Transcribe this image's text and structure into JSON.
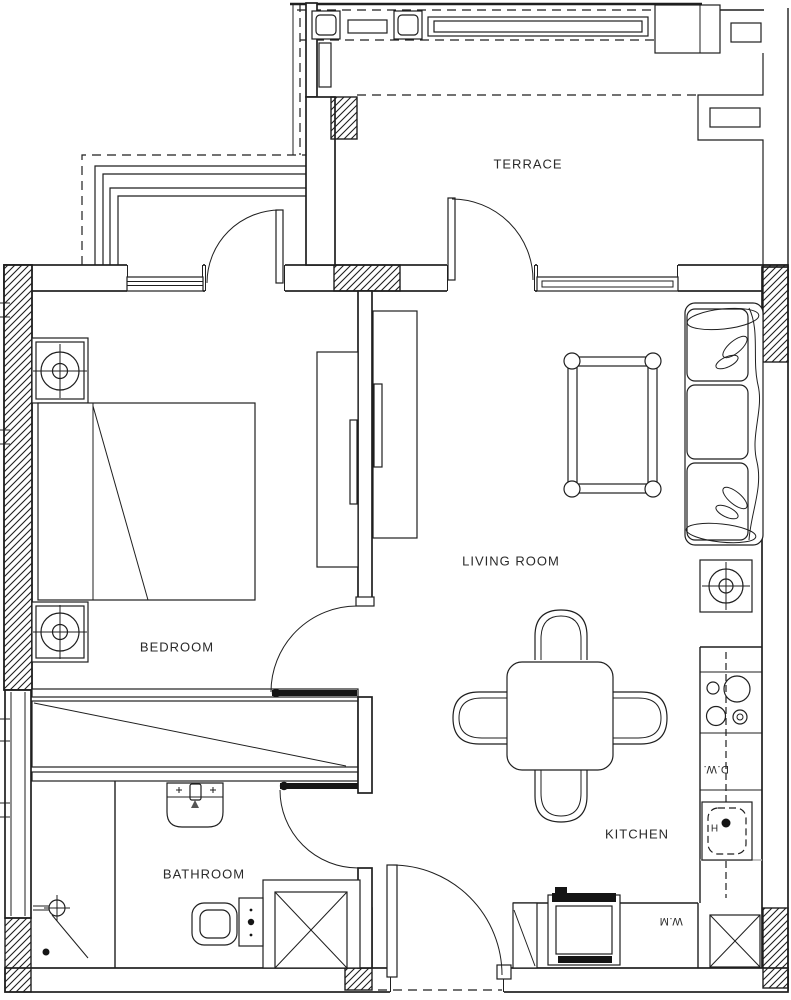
{
  "document": {
    "kind": "apartment-floor-plan"
  },
  "rooms": {
    "terrace": {
      "label": "TERRACE"
    },
    "bedroom": {
      "label": "BEDROOM"
    },
    "living_room": {
      "label": "LIVING ROOM"
    },
    "bathroom": {
      "label": "BATHROOM"
    },
    "kitchen": {
      "label": "KITCHEN"
    }
  },
  "appliances": {
    "dishwasher": {
      "label": "D.W."
    },
    "washing_machine": {
      "label": "W.M"
    },
    "kitchen_sink": {
      "label": "H"
    }
  },
  "colors": {
    "line": "#1f1f1f",
    "background": "#ffffff",
    "text": "#2a2a2a"
  }
}
